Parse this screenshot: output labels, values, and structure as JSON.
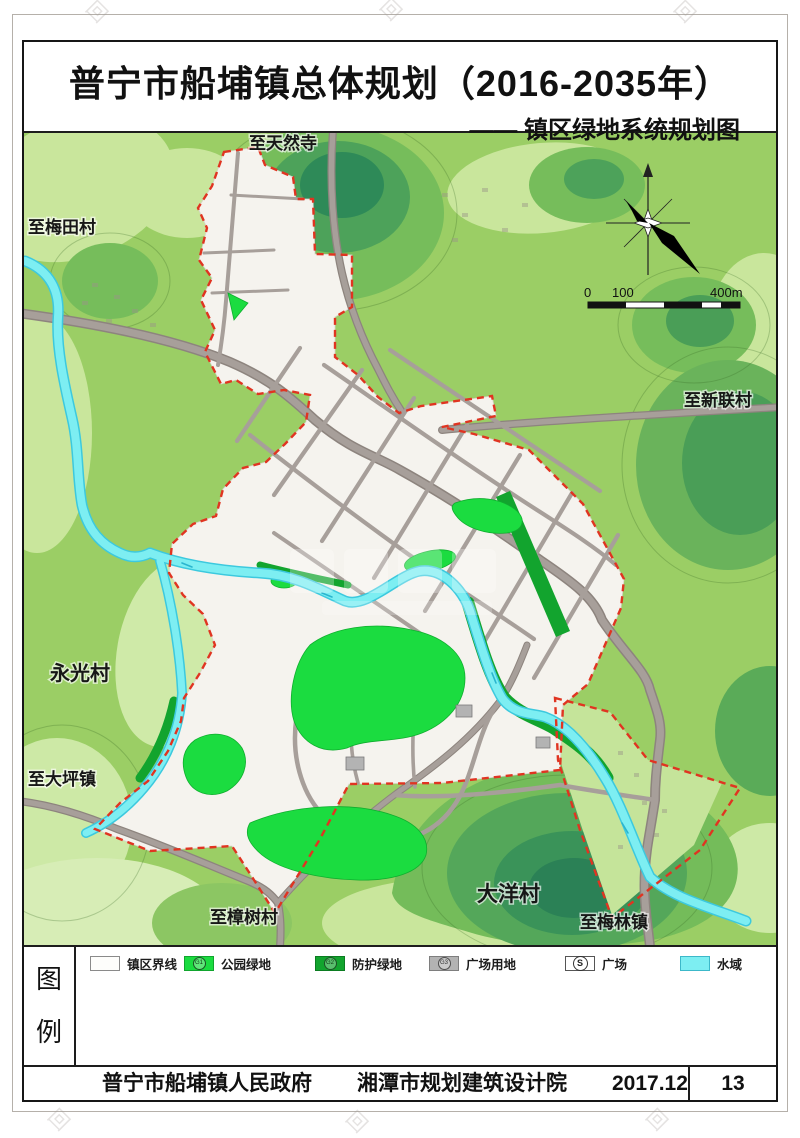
{
  "page": {
    "title": "普宁市船埔镇总体规划（2016-2035年）",
    "subtitle": "—— 镇区绿地系统规划图"
  },
  "map": {
    "labels": [
      {
        "id": "tianran-temple",
        "text": "至天然寺"
      },
      {
        "id": "meitian-village",
        "text": "至梅田村"
      },
      {
        "id": "xinlian-village",
        "text": "至新联村"
      },
      {
        "id": "yongguang-village",
        "text": "永光村"
      },
      {
        "id": "daping-town",
        "text": "至大坪镇"
      },
      {
        "id": "zhangshu-village",
        "text": "至樟树村"
      },
      {
        "id": "dayang-village",
        "text": "大洋村"
      },
      {
        "id": "meilin-town",
        "text": "至梅林镇"
      }
    ],
    "scale_bar": {
      "tick_0": "0",
      "tick_100": "100",
      "tick_400": "400m"
    }
  },
  "legend": {
    "heading": [
      "图",
      "例"
    ],
    "items": [
      {
        "label": "镇区界线",
        "type": "boundary",
        "code": ""
      },
      {
        "label": "公园绿地",
        "type": "park",
        "code": "G1"
      },
      {
        "label": "防护绿地",
        "type": "protective",
        "code": "G2"
      },
      {
        "label": "广场用地",
        "type": "plaza-land",
        "code": "G3"
      },
      {
        "label": "广场",
        "type": "square",
        "code": "S"
      },
      {
        "label": "水域",
        "type": "water",
        "code": ""
      }
    ]
  },
  "footer": {
    "government": "普宁市船埔镇人民政府",
    "institute": "湘潭市规划建筑设计院",
    "date": "2017.12",
    "page_number": "13"
  },
  "colors": {
    "park_green": "#1bdc40",
    "protective_green": "#12a42e",
    "water_cyan": "#7deef2",
    "boundary_red": "#e03421",
    "road_gray": "#a59d98",
    "plaza_gray": "#b3b3b3",
    "urban_white": "#f5f3ee",
    "terrain_base": "#9bce65"
  }
}
